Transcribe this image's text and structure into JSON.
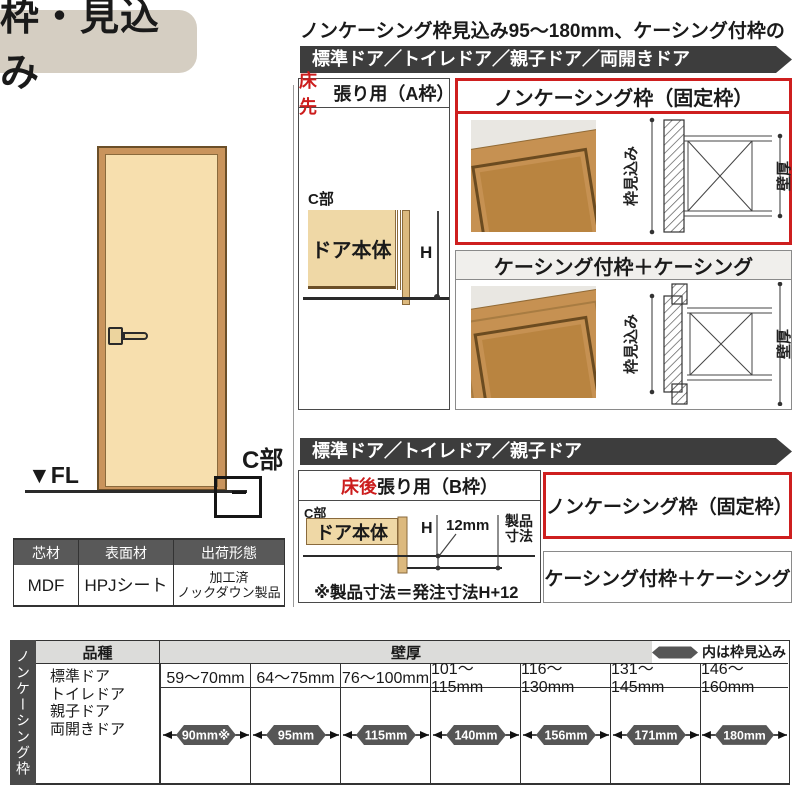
{
  "title": "枠・見込み",
  "subtitle": "ノンケーシング枠見込み95～180mm、ケーシング付枠の場合",
  "bars": {
    "top": "標準ドア／トイレドア／親子ドア／両開きドア",
    "middle": "標準ドア／トイレドア／親子ドア"
  },
  "door_figure": {
    "fl": "▼FL",
    "c": "C部"
  },
  "section_a": {
    "header_red": "床先",
    "header_rest": "張り用（A枠）",
    "c": "C部",
    "door_body": "ドア本体",
    "h": "H"
  },
  "noncasing": {
    "title": "ノンケーシング枠（固定枠）",
    "depth_label": "枠見込み",
    "wall_label": "壁厚"
  },
  "casing": {
    "title": "ケーシング付枠＋ケーシング",
    "depth_label": "枠見込み",
    "wall_label": "壁厚"
  },
  "section_b": {
    "header_red": "床後",
    "header_rest": "張り用（B枠）",
    "c": "C部",
    "door_body": "ドア本体",
    "h": "H",
    "gap": "12mm",
    "product_l1": "製品",
    "product_l2": "寸法",
    "note": "※製品寸法＝発注寸法H+12",
    "noncasing_label": "ノンケーシング枠（固定枠）",
    "casing_label": "ケーシング付枠＋ケーシング"
  },
  "material_table": {
    "headers": [
      "芯材",
      "表面材",
      "出荷形態"
    ],
    "core": "MDF",
    "surface": "HPJシート",
    "shipping_l1": "加工済",
    "shipping_l2": "ノックダウン製品"
  },
  "size_table": {
    "side_label": "ノンケーシング枠",
    "kind_header": "品種",
    "wall_header": "壁厚",
    "legend_label": "内は枠見込み",
    "door_types": [
      "標準ドア",
      "トイレドア",
      "親子ドア",
      "両開きドア"
    ],
    "wall_ranges": [
      "59～70mm",
      "64～75mm",
      "76～100mm",
      "101～115mm",
      "116～130mm",
      "131～145mm",
      "146～160mm"
    ],
    "frame_depths": [
      "90mm※",
      "95mm",
      "115mm",
      "140mm",
      "156mm",
      "171mm",
      "180mm"
    ]
  },
  "colors": {
    "accent_red": "#ce1f1f",
    "bar_dark": "#3d3d3d",
    "beige_door": "#f7dfae",
    "beige_panel": "#efd8a6",
    "wood": "#c9945c",
    "header_gray": "#595959",
    "title_bg": "#d5cec2",
    "badge_gray": "#565656",
    "table_header_bg": "#dcdcda"
  }
}
